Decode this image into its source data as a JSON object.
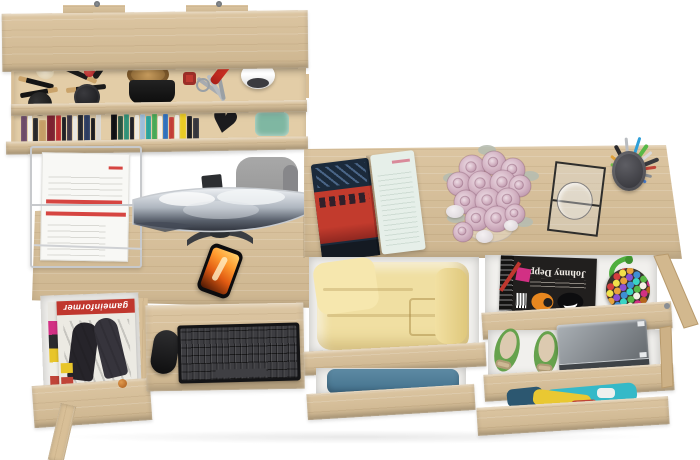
{
  "meta": {
    "description": "Top-down 3D product render of a Sonoma oak home-office set: wall shelf with books and accessories, desk with curved monitor, keyboard tray and open magazine drawer, and a second desk with open clothing drawers",
    "background": "#ffffff"
  },
  "palette": {
    "wood": "#d8bf97",
    "woodDark": "#c6ab7e",
    "woodLight": "#e3cda7",
    "interior": "#f1f0ed",
    "steel": "#c4c6c9",
    "chair": "#9e9e9e",
    "standDark": "#3a3d42",
    "magRed": "#c0372e",
    "fire": "#ff7c1e",
    "rose": "#d3b3c3",
    "leaf": "#b6bdb0",
    "yellowCloth": "#f0dfa2",
    "blueCloth": "#4a7da0",
    "tealCloth": "#35b9c8",
    "flatGreen": "#66a24d",
    "boxGray": "#8f959a",
    "strapGreen": "#4fae3e",
    "redLine": "#d64541",
    "pinkBadge": "#d23084",
    "orangeFace": "#e8871f"
  },
  "texts": {
    "gameinformer": "gameinformer",
    "johnny_depp": "Johnny Depp"
  },
  "wall_shelf": {
    "items": [
      "makeup brushes",
      "powder puff",
      "compact",
      "red lipstick",
      "straw hat",
      "black tray",
      "keys with red fob",
      "red pocket knife",
      "white mouse",
      "books",
      "heart ornament",
      "teal glass dish"
    ],
    "books": [
      {
        "w": 6,
        "h": 26,
        "c": "#6d4b68"
      },
      {
        "w": 4,
        "h": 28,
        "c": "#f1efe9"
      },
      {
        "w": 5,
        "h": 24,
        "c": "#262628"
      },
      {
        "w": 7,
        "h": 22,
        "c": "#c59e66"
      },
      {
        "w": 8,
        "h": 29,
        "c": "#7c2230"
      },
      {
        "w": 5,
        "h": 27,
        "c": "#bb2c2e"
      },
      {
        "w": 4,
        "h": 25,
        "c": "#1c1c1f"
      },
      {
        "w": 5,
        "h": 28,
        "c": "#3c3644"
      },
      {
        "w": 4,
        "h": 26,
        "c": "#e9e7e1"
      },
      {
        "w": 5,
        "h": 29,
        "c": "#23252c"
      },
      {
        "w": 6,
        "h": 27,
        "c": "#2c3c60"
      },
      {
        "w": 4,
        "h": 24,
        "c": "#18181b"
      },
      {
        "w": 5,
        "h": 28,
        "c": "#d9d6cf"
      },
      {
        "w": 8,
        "h": 0,
        "c": "transparent"
      },
      {
        "w": 6,
        "h": 30,
        "c": "#0f0f12"
      },
      {
        "w": 5,
        "h": 26,
        "c": "#2a5340"
      },
      {
        "w": 5,
        "h": 28,
        "c": "#2f9176"
      },
      {
        "w": 4,
        "h": 25,
        "c": "#1d1d23"
      },
      {
        "w": 4,
        "h": 27,
        "c": "#edeae3"
      },
      {
        "w": 5,
        "h": 28,
        "c": "#9dbdd9"
      },
      {
        "w": 5,
        "h": 26,
        "c": "#2ba29a"
      },
      {
        "w": 5,
        "h": 29,
        "c": "#49a955"
      },
      {
        "w": 4,
        "h": 26,
        "c": "#f3f1eb"
      },
      {
        "w": 5,
        "h": 28,
        "c": "#3070bb"
      },
      {
        "w": 5,
        "h": 25,
        "c": "#c33c35"
      },
      {
        "w": 4,
        "h": 27,
        "c": "#f0ede5"
      },
      {
        "w": 6,
        "h": 29,
        "c": "#e9ca24"
      },
      {
        "w": 5,
        "h": 26,
        "c": "#1b1b1f"
      },
      {
        "w": 6,
        "h": 24,
        "c": "#35353b"
      }
    ]
  },
  "left_desk": {
    "monitor": {
      "type": "curved ultrawide",
      "wallpaper": "snowy mountains"
    },
    "chair": "gray office chair",
    "phone": {
      "screen": "orange fire artwork"
    },
    "document_tray": "wire tray with white papers, red headings",
    "drawer_magazine": {
      "title": "gameinformer",
      "cover": "black and white figures"
    },
    "keyboard": "black keyboard",
    "mouse": "black mouse"
  },
  "right_desk": {
    "open_magazine": {
      "left_page": "red London bus photo",
      "right_page": "pale text page"
    },
    "flowers": {
      "type": "dusty pink rose bouquet",
      "roses": [
        {
          "x": 34,
          "y": 28,
          "r": 13
        },
        {
          "x": 56,
          "y": 23,
          "r": 12
        },
        {
          "x": 75,
          "y": 30,
          "r": 12
        },
        {
          "x": 21,
          "y": 44,
          "r": 12
        },
        {
          "x": 43,
          "y": 44,
          "r": 13
        },
        {
          "x": 65,
          "y": 43,
          "r": 13
        },
        {
          "x": 82,
          "y": 46,
          "r": 11
        },
        {
          "x": 28,
          "y": 62,
          "r": 12
        },
        {
          "x": 50,
          "y": 61,
          "r": 13
        },
        {
          "x": 70,
          "y": 60,
          "r": 12
        },
        {
          "x": 39,
          "y": 79,
          "r": 12
        },
        {
          "x": 59,
          "y": 79,
          "r": 13
        },
        {
          "x": 25,
          "y": 92,
          "r": 10
        },
        {
          "x": 77,
          "y": 74,
          "r": 10
        }
      ],
      "leaves": [
        {
          "x": 14,
          "y": 38
        },
        {
          "x": 92,
          "y": 36
        },
        {
          "x": 18,
          "y": 78
        },
        {
          "x": 86,
          "y": 82
        },
        {
          "x": 49,
          "y": 10
        }
      ]
    },
    "stones": 3,
    "glass_frame": "glass photo frame with tumbler",
    "pen_cup": {
      "pens": [
        {
          "a": -95,
          "l": 32,
          "c": "#b9bcc0",
          "w": 3
        },
        {
          "a": -72,
          "l": 34,
          "c": "#2f9fd8",
          "w": 3
        },
        {
          "a": -55,
          "l": 30,
          "c": "#58b847",
          "w": 4
        },
        {
          "a": -40,
          "l": 28,
          "c": "#d8d8da",
          "w": 3
        },
        {
          "a": -22,
          "l": 30,
          "c": "#3a3a3e",
          "w": 4
        },
        {
          "a": -8,
          "l": 26,
          "c": "#c04438",
          "w": 3
        },
        {
          "a": 14,
          "l": 22,
          "c": "#8a8d91",
          "w": 3
        },
        {
          "a": -118,
          "l": 27,
          "c": "#2b2b2e",
          "w": 4
        },
        {
          "a": -140,
          "l": 22,
          "c": "#e0a23a",
          "w": 3
        },
        {
          "a": 34,
          "l": 19,
          "c": "#4a7fd1",
          "w": 3
        },
        {
          "a": -160,
          "l": 18,
          "c": "#74c04a",
          "w": 3
        }
      ]
    },
    "drawers": {
      "top_left": "folded yellow clothes",
      "mid_left": "folded blue jeans",
      "top_right": "Johnny Depp magazine and multicolor beaded bag",
      "mid_right": "green ballet flats with bows, gray metal box",
      "bottom_right": "colorful summer clothes"
    },
    "bag_bead_colors": [
      "#d43d3d",
      "#e8a23a",
      "#3f8fd4",
      "#57b847",
      "#d23084",
      "#f0e04a",
      "#8a4fd1",
      "#3ad4c4",
      "#f5f0e6",
      "#b5651d"
    ]
  }
}
